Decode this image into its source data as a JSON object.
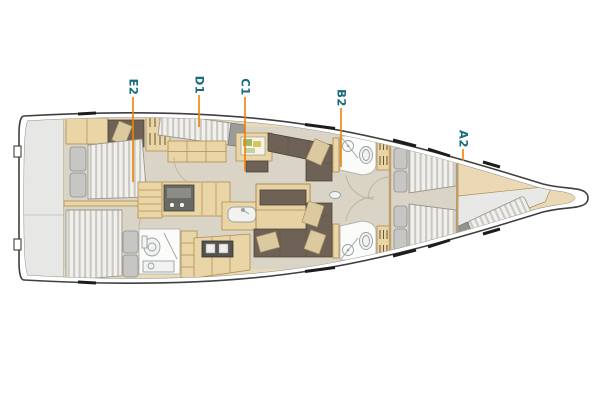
{
  "plan": {
    "labels": [
      {
        "id": "E2"
      },
      {
        "id": "D1"
      },
      {
        "id": "C1"
      },
      {
        "id": "B2"
      },
      {
        "id": "A2"
      }
    ],
    "colors": {
      "label_text": "#196b7d",
      "leader_line": "#f08300",
      "hull_outline": "#3f3f3f",
      "inner_sheer": "#8a8a82",
      "floor": "#d9d4c6",
      "furniture_tan": "#e9d5a5",
      "upholstery_brown": "#6e6156",
      "cushion_beige": "#dbc9a0",
      "mattress_white": "#f1f0ec",
      "mattress_stripe": "#c9c8c2",
      "platform_gray": "#e7e7e5",
      "bathroom_white": "#fbfbf9"
    }
  }
}
